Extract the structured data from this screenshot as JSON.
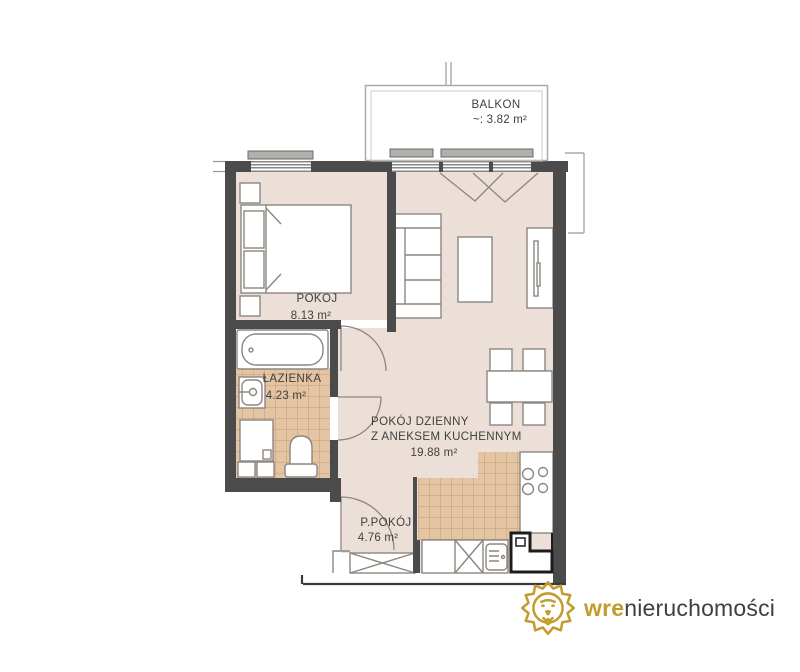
{
  "floorplan": {
    "balcony": {
      "label": "BALKON",
      "area": "~:  3.82 m²"
    },
    "rooms": {
      "bedroom": {
        "label": "POKOJ",
        "area": "8.13 m²"
      },
      "bathroom": {
        "label": "ŁAZIENKA",
        "area": "4.23 m²"
      },
      "living": {
        "label_line1": "POKÓJ DZIENNY",
        "label_line2": "Z ANEKSEM KUCHENNYM",
        "area": "19.88 m²"
      },
      "hallway": {
        "label": "P.POKÓJ",
        "area": "4.76 m²"
      }
    }
  },
  "logo": {
    "brand_primary": "wre",
    "brand_secondary": "nieruchomości"
  },
  "colors": {
    "floor": "#EBDFD8",
    "tile": "#E3C4A3",
    "tile_grid": "#C89A72",
    "wall": "#4B4B4B",
    "furniture_line": "#8C8680",
    "gold": "#C49B2C",
    "text": "#3F3F3F"
  }
}
